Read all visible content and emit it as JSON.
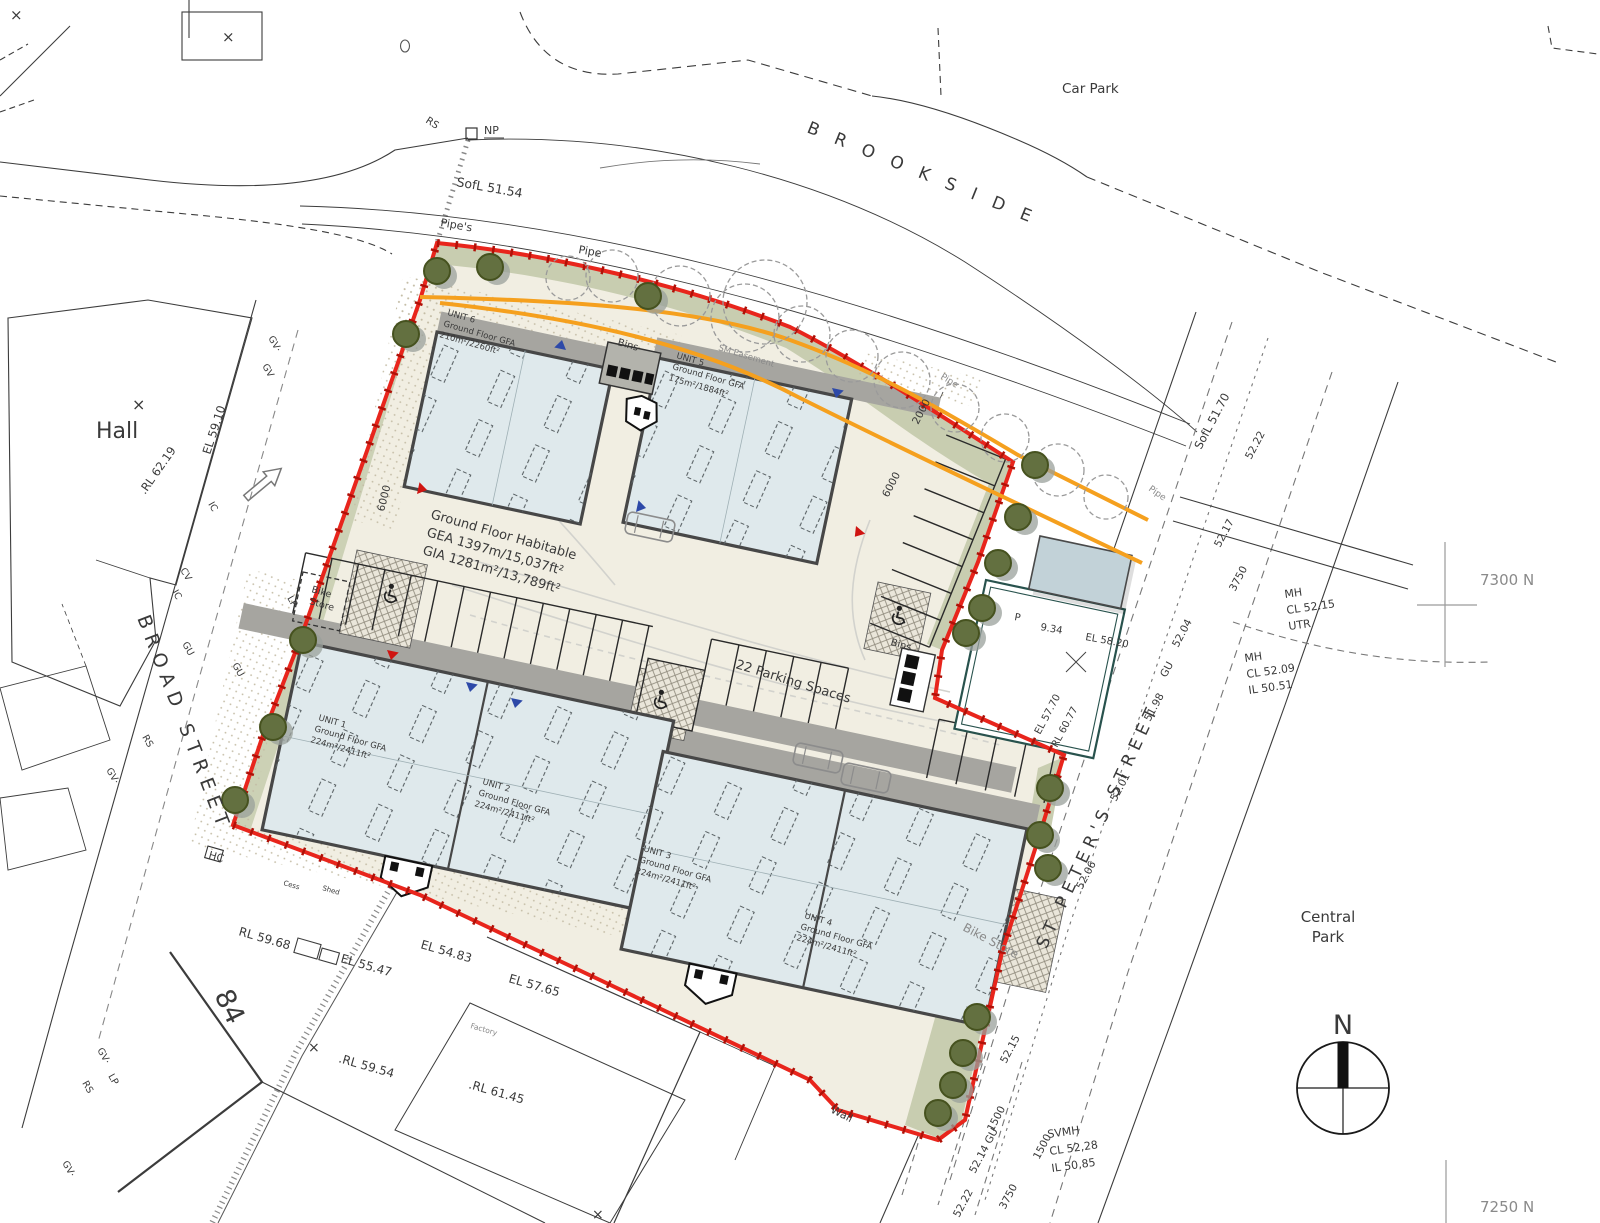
{
  "plan": {
    "streets": {
      "brookside": "B R O O K S I D E",
      "broad": "BROAD STREET",
      "st_peters": "ST PETER'S STREET"
    },
    "places": {
      "hall": "Hall",
      "car_park": "Car Park",
      "central_1": "Central",
      "central_2": "Park",
      "house": "84",
      "factory": "Factory",
      "cess": "Cess",
      "shed": "Shed"
    },
    "compass_n": "N",
    "grid": {
      "n7300": "7300 N",
      "n7250": "7250 N"
    },
    "units": [
      {
        "name": "UNIT 1",
        "floor": "Ground Floor GFA",
        "area": "224m²/2411ft²"
      },
      {
        "name": "UNIT 2",
        "floor": "Ground Floor GFA",
        "area": "224m²/2411ft²"
      },
      {
        "name": "UNIT 3",
        "floor": "Ground Floor GFA",
        "area": "224m²/2411ft²"
      },
      {
        "name": "UNIT 4",
        "floor": "Ground Floor GFA",
        "area": "224m²/2411ft²"
      },
      {
        "name": "UNIT 5",
        "floor": "Ground Floor GFA",
        "area": "175m²/1884ft²"
      },
      {
        "name": "UNIT 6",
        "floor": "Ground Floor GFA",
        "area": "210m²/2260ft²"
      }
    ],
    "summary": {
      "l1": "Ground Floor Habitable",
      "l2": "GEA 1397m/15,037ft²",
      "l3": "GIA 1281m²/13,789ft²"
    },
    "site": {
      "parking": "22 Parking Spaces",
      "bins": "Bins",
      "bike1a": "Bike",
      "bike1b": "Store",
      "bike2": "Bike Store",
      "wall": "Wall",
      "easement": "SM Easement",
      "np": "NP",
      "rs": "RS",
      "pipes": "Pipe's",
      "pipe": "Pipe",
      "o": "O",
      "x": "×"
    },
    "levels": {
      "sofl_a": "SofL 51.54",
      "sofl_b": "SofL 51.70",
      "el_a": "EL 59.10",
      "rl_a": ".RL 62.19",
      "rl_b": "RL 59.68",
      "el_b": "EL 55.47",
      "el_c": "EL 54.83",
      "el_d": "EL 57.65",
      "rl_c": ".RL 59.54",
      "rl_d": ".RL 61.45",
      "el_e": "EL 57.70",
      "rl_e": "RL 60.77",
      "el_f": "EL 58.20",
      "p": "P",
      "g934": "9.34"
    },
    "manholes": {
      "m1a": "MH",
      "m1b": "CL 52.15",
      "m1c": "UTR",
      "m2a": "MH",
      "m2b": "CL 52.09",
      "m2c": "IL 50.51",
      "m3a": "SVMH",
      "m3b": "CL 52,28",
      "m3c": "IL 50,85"
    },
    "dims": {
      "d6000": "6000",
      "d2000": "2000",
      "d3750": "3750",
      "d1500": "1500",
      "v5204": "52.04",
      "v5198": "51.98",
      "v5201": "52.01",
      "v5206": "52.06",
      "v5215": "52.15",
      "v5214": "52.14 GU",
      "v5222": "52.22",
      "v5217": "52.17",
      "gu": "GU"
    },
    "utilities": {
      "gv": "GV·",
      "gv2": "GV",
      "rs": "RS",
      "lp": "LP",
      "gu": "GU",
      "ic": "IC",
      "cv": "CV",
      "hc": "HC"
    }
  }
}
